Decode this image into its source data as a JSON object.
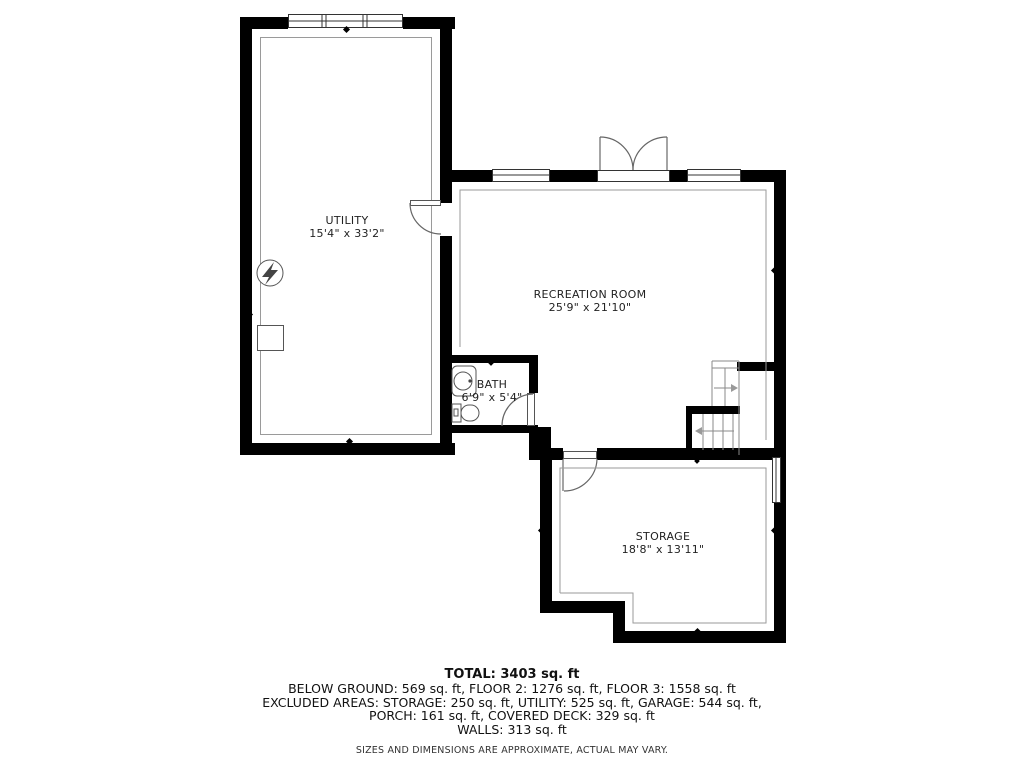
{
  "title": "Below ground floor plan",
  "rooms": [
    {
      "name": "UTILITY",
      "dims": "15'4\" x 33'2\""
    },
    {
      "name": "RECREATION ROOM",
      "dims": "25'9\" x 21'10\""
    },
    {
      "name": "BATH",
      "dims": "6'9\" x 5'4\""
    },
    {
      "name": "STORAGE",
      "dims": "18'8\" x 13'11\""
    }
  ],
  "footer": {
    "total": "TOTAL: 3403 sq. ft",
    "line1": "BELOW GROUND: 569 sq. ft, FLOOR 2: 1276 sq. ft, FLOOR 3: 1558 sq. ft",
    "line2": "EXCLUDED AREAS: STORAGE: 250 sq. ft, UTILITY: 525 sq. ft, GARAGE: 544 sq. ft,",
    "line3": "PORCH: 161 sq. ft, COVERED DECK: 329 sq. ft",
    "line4": "WALLS: 313 sq. ft",
    "disclaimer": "SIZES AND DIMENSIONS ARE APPROXIMATE, ACTUAL MAY VARY."
  },
  "icons": {
    "electrical": "lightning-bolt-circle",
    "sump": "square-outline",
    "stairs_up_arrow": "arrow-right",
    "stairs_down_arrow": "arrow-left"
  },
  "colors": {
    "wall": "#000000",
    "thin_line": "#9a9a9a",
    "fixture_line": "#555555",
    "text": "#222222"
  }
}
